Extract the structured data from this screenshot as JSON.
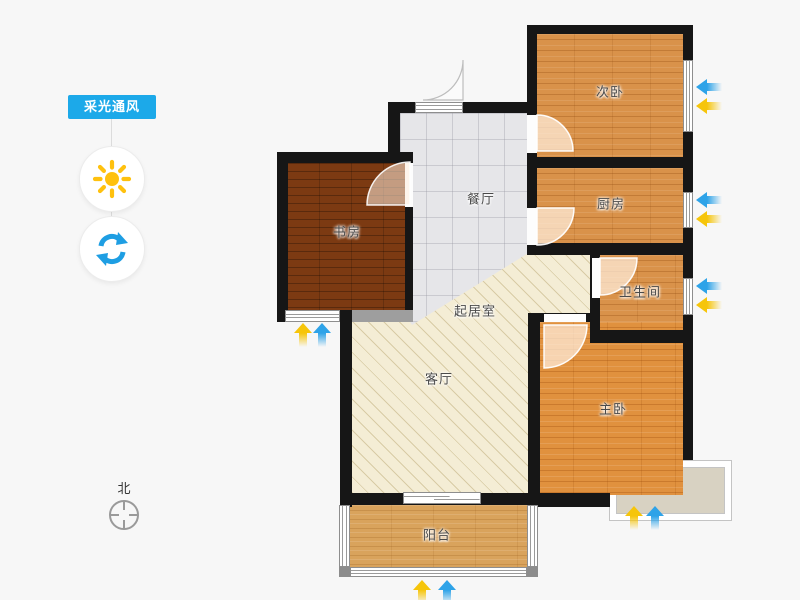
{
  "sidebar": {
    "toggle_label": "采光通风",
    "icons": {
      "sun": "sun-icon",
      "refresh": "refresh-icon"
    }
  },
  "compass": {
    "north_label": "北"
  },
  "rooms": {
    "secondary_bedroom": "次卧",
    "kitchen": "厨房",
    "bathroom": "卫生间",
    "dining_room": "餐厅",
    "study": "书房",
    "living_room": "起居室",
    "parlor": "客厅",
    "master_bedroom": "主卧",
    "balcony": "阳台"
  },
  "colors": {
    "accent_blue": "#1CA9E9",
    "arrow_blue": "#2EA3E8",
    "arrow_yellow": "#F6C50A",
    "wall": "#161616",
    "wood_orange": "#D9924A",
    "wood_master": "#E0913E",
    "wood_dark": "#7C3A12",
    "wood_balcony": "#D9A35C",
    "tile_gray": "#E6E6E9",
    "hatch_cream": "#F4EDD5",
    "bay_fill": "#D8D2C2"
  }
}
